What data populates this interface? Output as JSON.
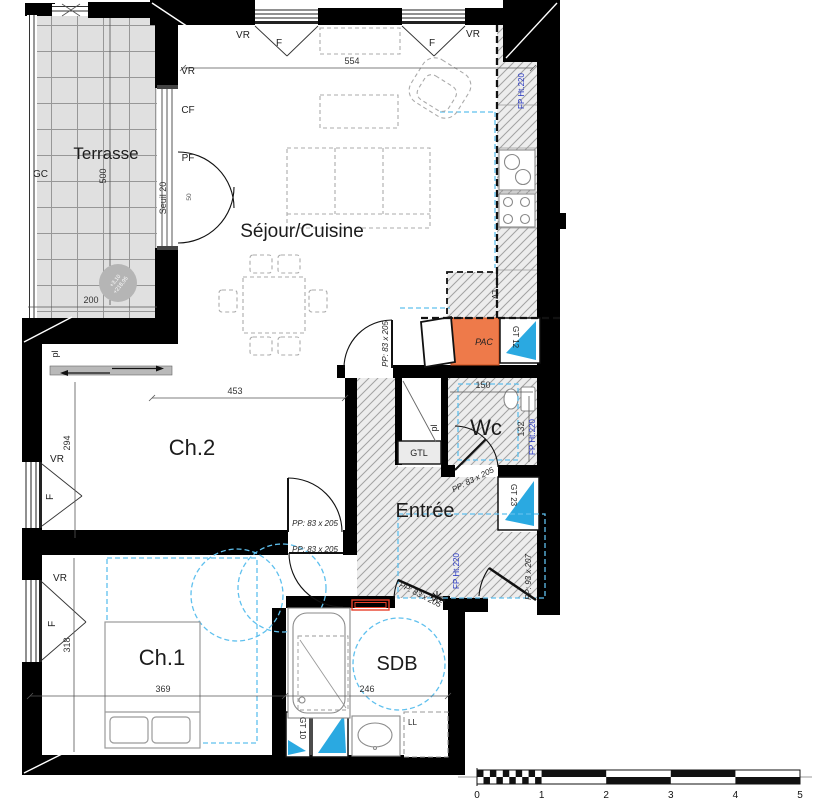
{
  "rooms": {
    "terrasse": "Terrasse",
    "sejour": "Séjour/Cuisine",
    "ch2": "Ch.2",
    "ch1": "Ch.1",
    "entree": "Entrée",
    "wc": "Wc",
    "sdb": "SDB"
  },
  "window_labels": {
    "vr": "VR",
    "f": "F",
    "cf": "CF",
    "pf": "PF",
    "gc": "GC"
  },
  "dimensions": {
    "sejour_width": "554",
    "terrasse_height": "500",
    "terrasse_width": "200",
    "seuil": "Seuil 20",
    "bay": "50",
    "ch2_width": "453",
    "ch2_height": "294",
    "ch1_width": "369",
    "ch1_height": "318",
    "sdb_width": "246",
    "wc_width": "150",
    "wc_height": "132"
  },
  "doors": {
    "pp83": "PP: 83 x 205",
    "pp93": "PP: 93 x 207"
  },
  "tech": {
    "fp": "FP Ht.220",
    "gt12": "GT 12",
    "gt23": "GT 23",
    "gt10": "GT 10",
    "gtl": "GTL",
    "pac": "PAC",
    "lv": "LV",
    "ll": "LL",
    "pl": "pl"
  },
  "level_marker": {
    "line1": "+3,10",
    "line2": "+218,95"
  },
  "scale_bar": {
    "labels": [
      "0",
      "1",
      "2",
      "3",
      "4",
      "5"
    ]
  },
  "colors": {
    "wall": "#000000",
    "pac_orange": "#ee7a4a",
    "gt_blue": "#2aa9e1",
    "fp_blue": "#2333c0",
    "accessibility_cyan": "#5fc0ee",
    "radiator_red": "#e8402a",
    "terrace_gray": "#e0e0e0",
    "hatch_gray": "#ededed"
  }
}
